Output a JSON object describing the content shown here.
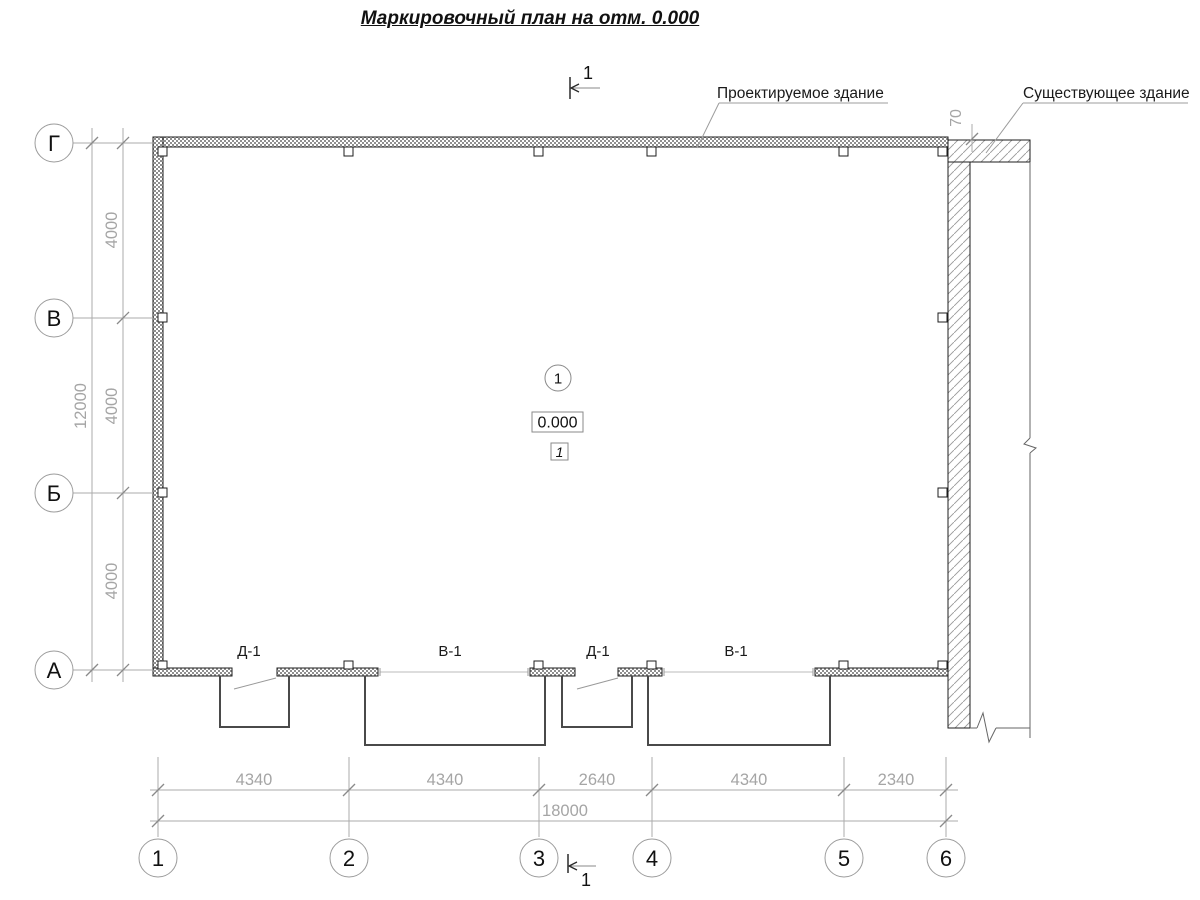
{
  "title": {
    "text": "Маркировочный план на отм. 0.000"
  },
  "annotations": {
    "projected_building": "Проектируемое здание",
    "existing_building": "Существующее здание",
    "gap_dimension": "70"
  },
  "section_mark": {
    "label": "1"
  },
  "room": {
    "number": "1",
    "elevation": "0.000",
    "floor_type": "1"
  },
  "openings": [
    {
      "label": "Д-1"
    },
    {
      "label": "В-1"
    },
    {
      "label": "Д-1"
    },
    {
      "label": "В-1"
    }
  ],
  "axes": {
    "vertical": [
      {
        "label": "Г",
        "y": 143
      },
      {
        "label": "В",
        "y": 318
      },
      {
        "label": "Б",
        "y": 493
      },
      {
        "label": "А",
        "y": 670
      }
    ],
    "horizontal": [
      {
        "label": "1",
        "x": 158
      },
      {
        "label": "2",
        "x": 349
      },
      {
        "label": "3",
        "x": 539
      },
      {
        "label": "4",
        "x": 652
      },
      {
        "label": "5",
        "x": 844
      },
      {
        "label": "6",
        "x": 946
      }
    ]
  },
  "dimensions": {
    "bottom_segments": [
      {
        "text": "4340",
        "x": 254
      },
      {
        "text": "4340",
        "x": 445
      },
      {
        "text": "2640",
        "x": 597
      },
      {
        "text": "4340",
        "x": 749
      },
      {
        "text": "2340",
        "x": 896
      }
    ],
    "bottom_total": {
      "text": "18000",
      "x": 565,
      "y": 816
    },
    "left_segments": [
      {
        "text": "4000",
        "y": 230
      },
      {
        "text": "4000",
        "y": 406
      },
      {
        "text": "4000",
        "y": 581
      }
    ],
    "left_total": {
      "text": "12000",
      "y": 406
    }
  },
  "colors": {
    "line_black": "#1c1c1c",
    "line_gray": "#ababab",
    "tick_gray": "#8a8a8a",
    "text_gray": "#a5a5a5",
    "porch": "#4a4a4a",
    "break": "#666666"
  },
  "plan": {
    "walls": [
      [
        153,
        137,
        795,
        10
      ],
      [
        153,
        137,
        10,
        539
      ],
      [
        153,
        668,
        79,
        8
      ],
      [
        277,
        668,
        101,
        8
      ],
      [
        530,
        668,
        45,
        8
      ],
      [
        618,
        668,
        44,
        8
      ],
      [
        815,
        668,
        133,
        8
      ]
    ],
    "existing": [
      [
        948,
        140,
        22,
        588
      ],
      [
        948,
        140,
        82,
        22
      ]
    ],
    "pilasters": [
      [
        158,
        147,
        9,
        9
      ],
      [
        344,
        147,
        9,
        9
      ],
      [
        534,
        147,
        9,
        9
      ],
      [
        647,
        147,
        9,
        9
      ],
      [
        839,
        147,
        9,
        9
      ],
      [
        938,
        147,
        9,
        9
      ],
      [
        158,
        313,
        9,
        9
      ],
      [
        938,
        313,
        9,
        9
      ],
      [
        158,
        488,
        9,
        9
      ],
      [
        938,
        488,
        9,
        9
      ],
      [
        158,
        661,
        9,
        8
      ],
      [
        344,
        661,
        9,
        8
      ],
      [
        534,
        661,
        9,
        8
      ],
      [
        647,
        661,
        9,
        8
      ],
      [
        839,
        661,
        9,
        8
      ],
      [
        938,
        661,
        9,
        8
      ]
    ],
    "porches": [
      [
        220,
        676,
        289,
        727
      ],
      [
        365,
        676,
        545,
        745
      ],
      [
        562,
        676,
        632,
        727
      ],
      [
        648,
        676,
        830,
        745
      ]
    ],
    "doors": [
      [
        234,
        689,
        276,
        678
      ],
      [
        577,
        689,
        618,
        678
      ]
    ],
    "windows": [
      [
        380,
        672,
        528
      ],
      [
        664,
        672,
        813
      ]
    ],
    "gray_lines": [
      [
        73,
        143,
        153,
        143
      ],
      [
        73,
        318,
        153,
        318
      ],
      [
        73,
        493,
        153,
        493
      ],
      [
        73,
        670,
        153,
        670
      ],
      [
        123,
        128,
        123,
        682
      ],
      [
        92,
        128,
        92,
        682
      ],
      [
        158,
        757,
        158,
        837
      ],
      [
        349,
        757,
        349,
        837
      ],
      [
        539,
        757,
        539,
        837
      ],
      [
        652,
        757,
        652,
        837
      ],
      [
        844,
        757,
        844,
        837
      ],
      [
        946,
        757,
        946,
        837
      ],
      [
        150,
        790,
        958,
        790
      ],
      [
        150,
        821,
        958,
        821
      ],
      [
        972,
        124,
        972,
        152
      ]
    ],
    "leader_lines": [
      [
        719,
        103,
        888,
        103
      ],
      [
        719,
        103,
        697,
        148
      ],
      [
        1023,
        103,
        1188,
        103
      ],
      [
        1023,
        103,
        986,
        153
      ]
    ],
    "break_lines": [
      [
        1030,
        162,
        1030,
        438
      ],
      [
        1030,
        453,
        1030,
        738
      ],
      [
        970,
        728,
        977,
        728
      ],
      [
        996,
        728,
        1030,
        728
      ]
    ],
    "section_lines": [
      [
        570,
        77,
        570,
        99
      ],
      [
        568,
        854,
        568,
        873
      ]
    ],
    "section_arrow_lines": [
      [
        572,
        88,
        600,
        88
      ],
      [
        570,
        866,
        596,
        866
      ]
    ],
    "polylines": [
      {
        "pts": [
          [
            1030,
            438
          ],
          [
            1024,
            444
          ],
          [
            1036,
            448
          ],
          [
            1030,
            453
          ]
        ],
        "c": "#666",
        "w": 1
      },
      {
        "pts": [
          [
            977,
            728
          ],
          [
            983,
            713
          ],
          [
            989,
            742
          ],
          [
            996,
            728
          ]
        ],
        "c": "#666",
        "w": 1
      },
      {
        "pts": [
          [
            579,
            84
          ],
          [
            571,
            88
          ],
          [
            579,
            92
          ]
        ],
        "c": "#2a2a2a",
        "w": 1.3
      },
      {
        "pts": [
          [
            577,
            862
          ],
          [
            569,
            866
          ],
          [
            577,
            870
          ]
        ],
        "c": "#2a2a2a",
        "w": 1.3
      }
    ],
    "ticks": [
      [
        123,
        143
      ],
      [
        123,
        318
      ],
      [
        123,
        493
      ],
      [
        123,
        670
      ],
      [
        92,
        143
      ],
      [
        92,
        670
      ],
      [
        158,
        790
      ],
      [
        349,
        790
      ],
      [
        539,
        790
      ],
      [
        652,
        790
      ],
      [
        844,
        790
      ],
      [
        946,
        790
      ],
      [
        158,
        821
      ],
      [
        946,
        821
      ],
      [
        972,
        139
      ]
    ],
    "axis_bubbles_left_x": 54,
    "axis_bubbles_bottom_y": 858,
    "bubble_r": 19,
    "room_circle": {
      "cx": 558,
      "cy": 378,
      "r": 13
    },
    "elev_box": {
      "x": 532,
      "y": 412,
      "w": 51,
      "h": 20
    },
    "floor_box": {
      "x": 551,
      "y": 443,
      "w": 17,
      "h": 17
    }
  }
}
